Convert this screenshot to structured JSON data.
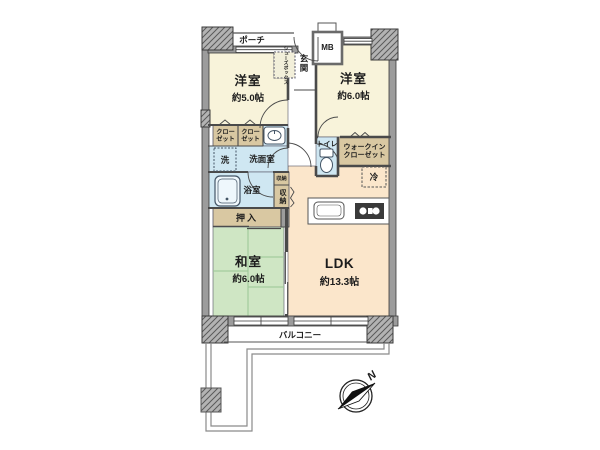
{
  "plan": {
    "title": "apartment-floorplan",
    "rooms": {
      "bedroom1": {
        "name": "洋室",
        "size": "約5.0帖"
      },
      "bedroom2": {
        "name": "洋室",
        "size": "約6.0帖"
      },
      "washitsu": {
        "name": "和室",
        "size": "約6.0帖"
      },
      "ldk": {
        "name": "LDK",
        "size": "約13.3帖"
      }
    },
    "labels": {
      "porch": "ポーチ",
      "mb": "MB",
      "entrance": "玄関",
      "shoebox": "シューズボックス",
      "closet1": "クローゼット",
      "closet2": "クローゼット",
      "washer": "洗",
      "washroom": "洗面室",
      "bath": "浴室",
      "storage_small": "収納",
      "storage": "収納",
      "oshiire": "押入",
      "toilet": "トイレ",
      "wic": "ウォークインクローゼット",
      "fridge": "冷",
      "balcony": "バルコニー",
      "compass_north": "N"
    },
    "colors": {
      "western_room": "#f8f3da",
      "tatami_room": "#cfe6c4",
      "tatami_line": "#9ac795",
      "ldk": "#fbe6cb",
      "wet_area": "#cfe7f2",
      "storage_tan": "#d9c8a2",
      "wall": "#9c9c9c",
      "pillar": "#b3b3b3",
      "line": "#4a4a4a",
      "background": "#ffffff"
    }
  }
}
